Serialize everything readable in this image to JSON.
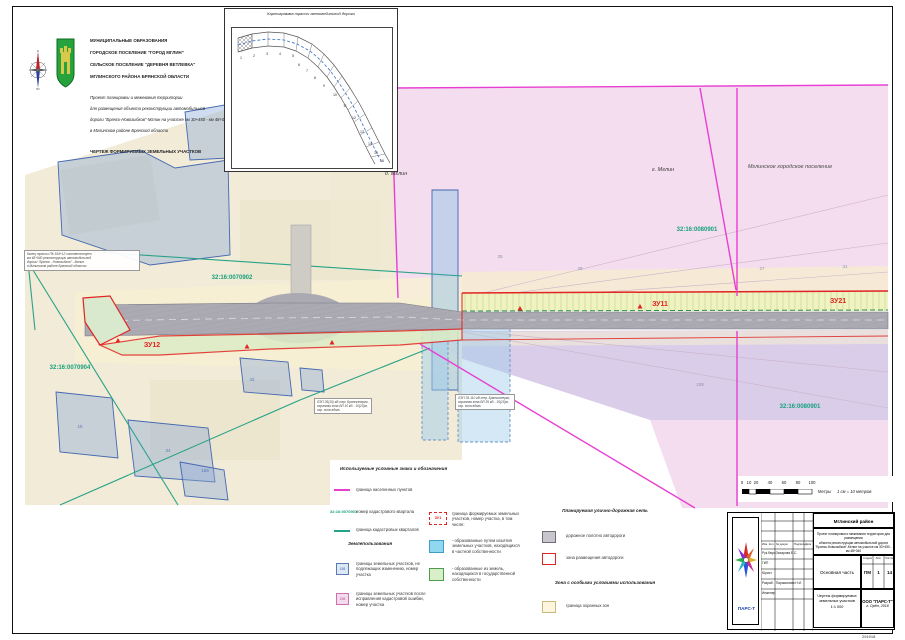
{
  "sheet": {
    "corner_number": "291918"
  },
  "compass": {
    "n": "С",
    "s": "Ю",
    "w": "З",
    "e": "В"
  },
  "header": {
    "municipalities": [
      "МУНИЦИПАЛЬНЫЕ ОБРАЗОВАНИЯ",
      "ГОРОДСКОЕ ПОСЕЛЕНИЕ \"ГОРОД МГЛИН\"",
      "СЕЛЬСКОЕ ПОСЕЛЕНИЕ \"ДЕРЕВНЯ ВЕТЛЕВКА\"",
      "МГЛИНСКОГО РАЙОНА БРЯНСКОЙ ОБЛАСТИ"
    ],
    "project": [
      "Проект планировки и межевания территории",
      "для размещения объекта реконструкции автомобильной",
      "дороги \"Брянск-Новозыбков\"-Мглин на участке км 30+450 - км 48+040",
      "в Мглинском районе Брянской области"
    ],
    "drawing_title": "ЧЕРТЕЖ ФОРМИРУЕМЫХ ЗЕМЕЛЬНЫХ УЧАСТКОВ"
  },
  "inset": {
    "title": "Картограмма трассы автомобильной дороги",
    "numbers": [
      "1",
      "2",
      "3",
      "4",
      "5",
      "6",
      "7",
      "8",
      "9",
      "10",
      "11",
      "12",
      "13",
      "14",
      "15",
      "16"
    ]
  },
  "map": {
    "labels": [
      {
        "text": "д. Мглин",
        "x": 396,
        "y": 175,
        "color": "#3a3a3a",
        "size": 5.5,
        "italic": true
      },
      {
        "text": "г. Мглин",
        "x": 663,
        "y": 171,
        "color": "#3a3a3a",
        "size": 5.5,
        "italic": true
      },
      {
        "text": "Мглинское городское поселение",
        "x": 790,
        "y": 168,
        "color": "#4a4a4a",
        "size": 5.5,
        "italic": true
      },
      {
        "text": "32:16:0070902",
        "x": 232,
        "y": 279,
        "color": "#17a07d",
        "size": 6,
        "bold": true
      },
      {
        "text": "32:16:0080901",
        "x": 697,
        "y": 231,
        "color": "#17a07d",
        "size": 6,
        "bold": true
      },
      {
        "text": "32:16:0070904",
        "x": 70,
        "y": 369,
        "color": "#17a07d",
        "size": 6,
        "bold": true
      },
      {
        "text": "32:16:0080901",
        "x": 800,
        "y": 408,
        "color": "#17a07d",
        "size": 6,
        "bold": true
      },
      {
        "text": "ЗУ12",
        "x": 152,
        "y": 347,
        "color": "#e02421",
        "size": 7,
        "bold": true
      },
      {
        "text": "ЗУ11",
        "x": 660,
        "y": 306,
        "color": "#e02421",
        "size": 7,
        "bold": true
      },
      {
        "text": "ЗУ21",
        "x": 838,
        "y": 303,
        "color": "#e02421",
        "size": 7,
        "bold": true
      },
      {
        "text": "15",
        "x": 80,
        "y": 428,
        "color": "#5b79b4",
        "size": 4.5
      },
      {
        "text": "34",
        "x": 168,
        "y": 452,
        "color": "#5b79b4",
        "size": 4.5
      },
      {
        "text": "158",
        "x": 205,
        "y": 472,
        "color": "#5b79b4",
        "size": 4.5
      },
      {
        "text": "42",
        "x": 252,
        "y": 381,
        "color": "#5b79b4",
        "size": 4.5
      },
      {
        "text": "25",
        "x": 500,
        "y": 258,
        "color": "#8a8fae",
        "size": 4.5
      },
      {
        "text": "28",
        "x": 580,
        "y": 270,
        "color": "#8a8fae",
        "size": 4.5
      },
      {
        "text": "27",
        "x": 762,
        "y": 270,
        "color": "#8a8fae",
        "size": 4.5
      },
      {
        "text": "31",
        "x": 845,
        "y": 268,
        "color": "#8a8fae",
        "size": 4.5
      },
      {
        "text": "108",
        "x": 700,
        "y": 386,
        "color": "#8a8fae",
        "size": 4.5
      }
    ],
    "note_start": [
      "Конец трассы ПК 184+12 соответствует",
      "км 48+040 реконструкции автомобильной",
      "дороги \"Брянск - Новозыбков\" - Мглин",
      "в Мглинском районе Брянской области"
    ],
    "note_lep_left": [
      "ЛЭП 35(10) кВ тер. Брянскэнерго,",
      "охранная зона ВЛ 10 кВ - 10(10)м,",
      "охр. зона вдоль"
    ],
    "note_lep_right": [
      "ЛЭП 35-110 кВ тер. Брянскэнерго,",
      "охранная зона ВЛ 35 кВ - 15(15)м,",
      "охр. зона вдоль"
    ]
  },
  "scalebar": {
    "ticks": [
      "0",
      "10",
      "20",
      "40",
      "60",
      "80",
      "100"
    ],
    "units_label": "Метры",
    "scale_note": "1 см = 10 метров"
  },
  "legend": {
    "title": "Используемые условные знаки и обозначения",
    "col1": [
      {
        "label": "граница населенных пунктов"
      },
      {
        "sample": "32:16:0070901",
        "label": "номер кадастрового квартала"
      },
      {
        "label": "граница кадастровых кварталов"
      }
    ],
    "subheader": "Землепользования",
    "col1b": [
      {
        "sample": "158",
        "label": "границы земельных участков, не подлежащих изменению, номер участка"
      },
      {
        "sample": "158",
        "label": "границы земельных участков после исправления кадастровой ошибки, номер участка"
      }
    ],
    "col2": [
      {
        "sample": "ЗУ1",
        "label": "граница формируемых земельных участков, номер участка, в том числе:"
      },
      {
        "label": "- образованные путем изъятия земельных участков, находящихся в частной собственности"
      },
      {
        "label": "- образованные из земель, находящихся в государственной собственности"
      }
    ],
    "col3_header": "Планируемая улично-дорожная сеть",
    "col3": [
      {
        "label": "дорожное полотно автодороги"
      },
      {
        "label": "зона размещения автодороги"
      }
    ],
    "col3_header2": "Зона с особыми условиями использования",
    "col3b": [
      {
        "label": "граница охранных зон"
      }
    ]
  },
  "stamp": {
    "district": "Мглинский район",
    "project_lines": [
      "Проект планировки и межевания территории для размещения",
      "объекта реконструкции автомобильной дороги",
      "\"Брянск-Новозыбков\"-Мглин на участке км 30+450 - км 48+040"
    ],
    "sig_header": [
      "Изм. Кол.",
      "№ докум.",
      "Подпись",
      "Дата"
    ],
    "sig_rows": [
      {
        "role": "Рук.бюро",
        "name": "Захарова Е.С."
      },
      {
        "role": "ГИП",
        "name": ""
      },
      {
        "role": "Юрист",
        "name": ""
      },
      {
        "role": "Разраб.",
        "name": "Парамонова Н.И."
      },
      {
        "role": "Инженер",
        "name": ""
      }
    ],
    "section_label": "Основная часть",
    "stage_headers": [
      "Стадия",
      "Лист",
      "Листов"
    ],
    "stage_values": [
      "ПМ",
      "1",
      "14"
    ],
    "sheet_title_lines": [
      "Чертеж формируемых",
      "земельных участков",
      "1:1 000"
    ],
    "org": "ООО \"ПАРС-Т\"",
    "org_city": "г. Орёл, 2016",
    "logo_text": "ПАРС-Т"
  },
  "colors": {
    "settlement_boundary": "#e83fd3",
    "cadastral_boundary": "#27a287",
    "formed_parcel": "#e02421",
    "road_surface": "#abaab3",
    "urban_pink": "#f4ddee",
    "purple_zone": "#d9cdea",
    "beige_land": "#f1ebd7",
    "parcel_blue": "#4468b0",
    "zu_green": "#dcecc6",
    "zu_band": "#eef3c0",
    "protect_cream": "#f8f0d4"
  }
}
